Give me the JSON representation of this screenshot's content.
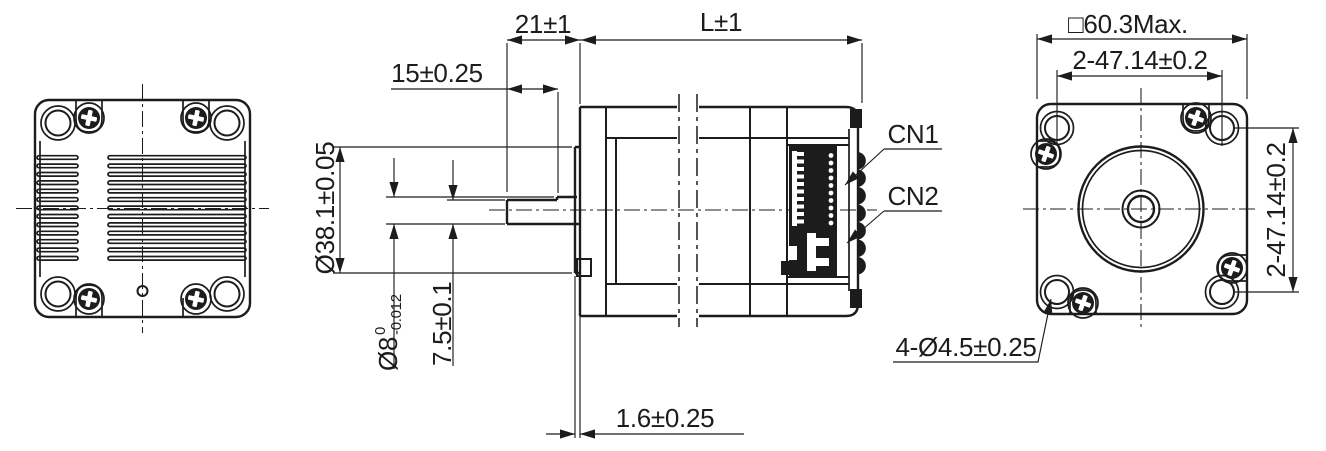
{
  "drawing": {
    "colors": {
      "line": "#1c1c1c",
      "background": "#ffffff"
    },
    "labels": {
      "shaft_projection": "21±1",
      "body_length": "L±1",
      "flat_length": "15±0.25",
      "pilot_diameter": "Ø38.1±0.05",
      "shaft_diameter": "Ø8",
      "shaft_tol_upper": "0",
      "shaft_tol_lower": "-0.012",
      "flat_height": "7.5±0.1",
      "pilot_thickness": "1.6±0.25",
      "frame_size": "□60.3Max.",
      "hole_pitch_horizontal": "2-47.14±0.2",
      "hole_pitch_vertical": "2-47.14±0.2",
      "mounting_holes": "4-Ø4.5±0.25",
      "connector1": "CN1",
      "connector2": "CN2"
    }
  }
}
